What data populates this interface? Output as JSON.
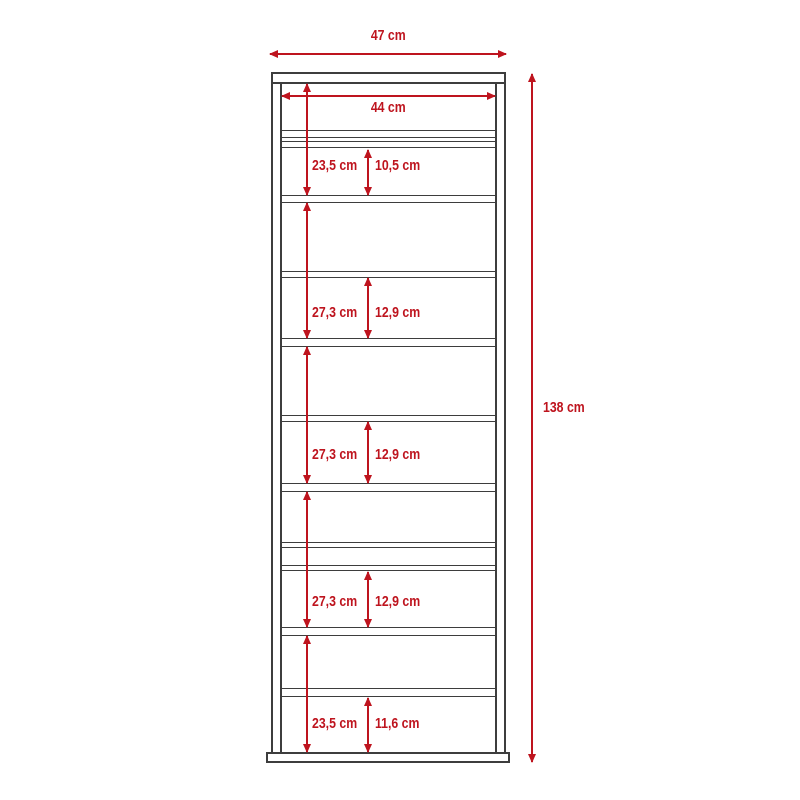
{
  "diagram": {
    "kind": "furniture dimension drawing (front elevation of tall shelf unit)",
    "accent_color": "#be141e",
    "line_color": "#3d3d3d",
    "dimensions": {
      "outer_width": "47 cm",
      "inner_width": "44 cm",
      "total_height": "138 cm",
      "sections": [
        {
          "height": "23,5 cm",
          "sub": "10,5 cm"
        },
        {
          "height": "27,3 cm",
          "sub": "12,9 cm"
        },
        {
          "height": "27,3 cm",
          "sub": "12,9 cm"
        },
        {
          "height": "27,3 cm",
          "sub": "12,9 cm"
        },
        {
          "height": "23,5 cm",
          "sub": "11,6 cm"
        }
      ]
    }
  }
}
